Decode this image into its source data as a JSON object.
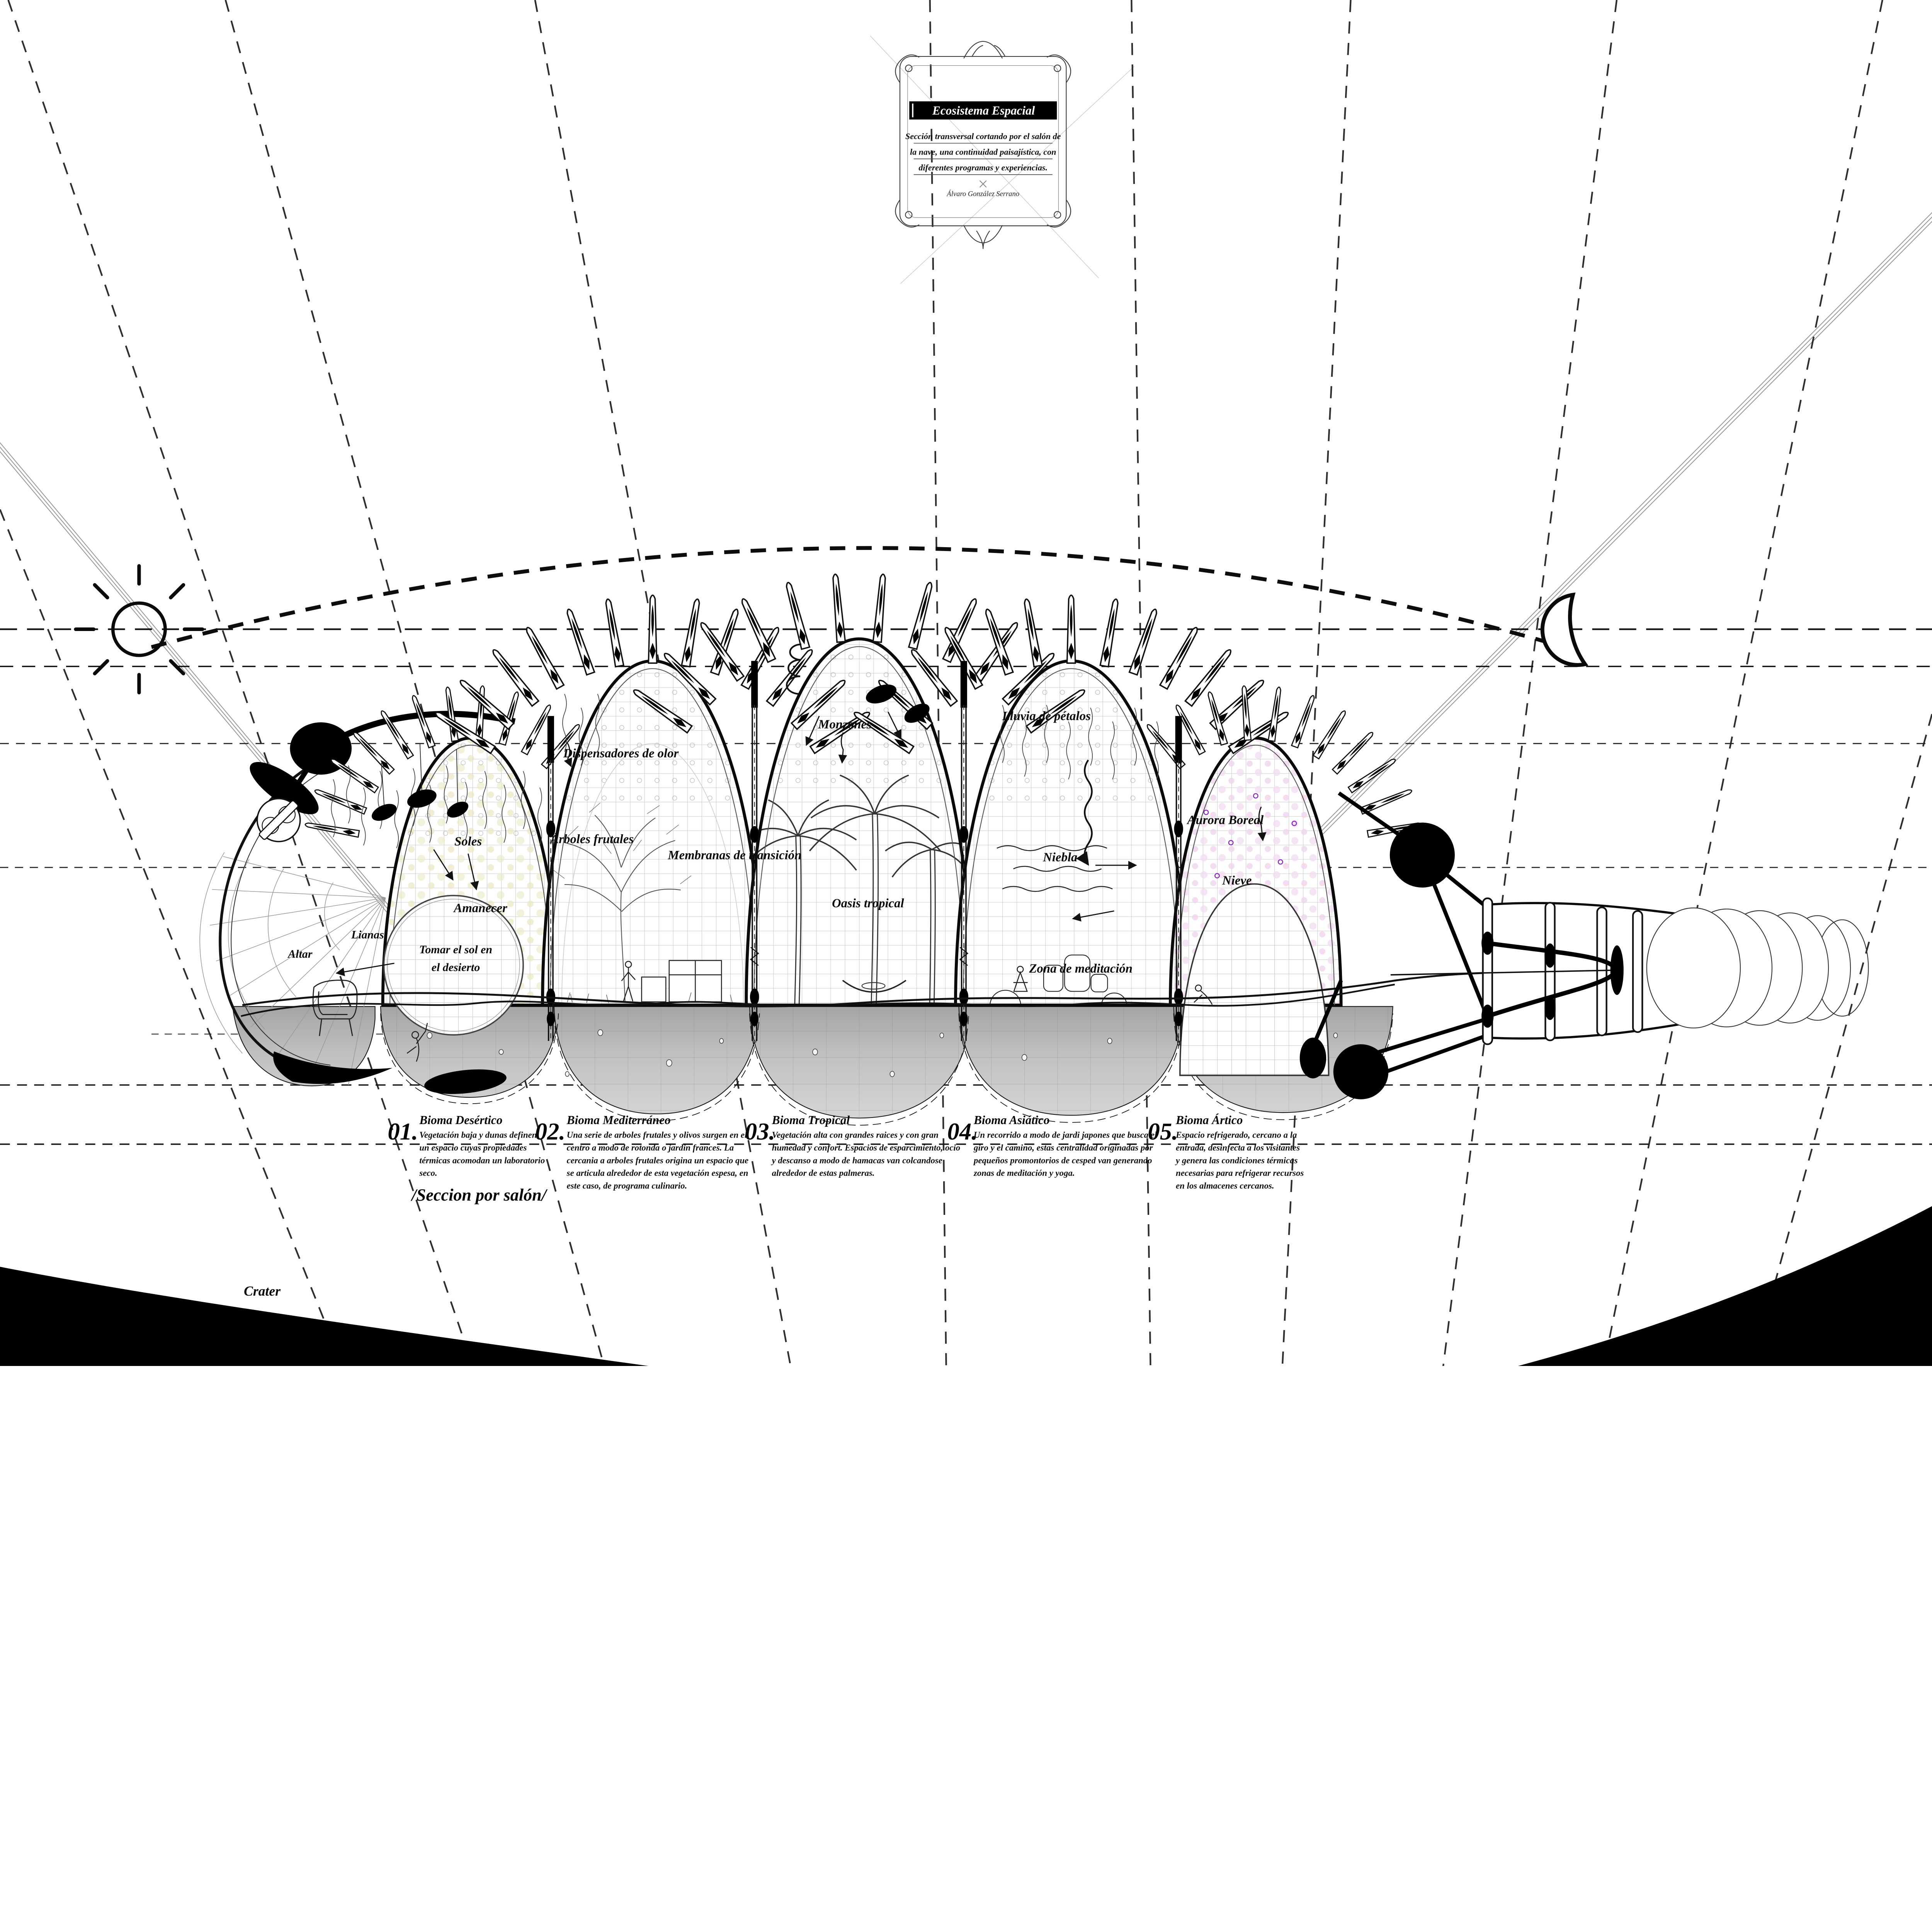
{
  "title_block": {
    "title": "Ecosistema Espacial",
    "subtitle_lines": [
      "Sección transversal cortando por el salón de",
      "la nave, una continuidad paisajística, con",
      "diferentes programas y experiencias."
    ],
    "author": "Álvaro González Serrano"
  },
  "annotations": {
    "soles": "Soles",
    "amanecer": "Amanecer",
    "lianas": "Lianas",
    "altar": "Altar",
    "tomar_1": "Tomar el sol en",
    "tomar_2": "el desierto",
    "dispensadores": "Dispensadores de olor",
    "arboles": "Árboles frutales",
    "membranas": "Membranas de transición",
    "monzones": "Monzones",
    "oasis": "Oasis tropical",
    "lluvia": "Lluvia de pétalos",
    "niebla": "Niebla",
    "aurora": "Aurora Boreal",
    "nieve": "Nieve",
    "zona": "Zona de meditación",
    "crater": "Crater",
    "seccion": "/Seccion por salón/"
  },
  "legend": {
    "items": [
      {
        "number": "01.",
        "name": "Bioma Desértico",
        "lines": [
          "Vegetación baja y dunas definen",
          "un espacio cuyas propiedades",
          "térmicas acomodan un laboratorio",
          "seco."
        ]
      },
      {
        "number": "02.",
        "name": "Bioma Mediterráneo",
        "lines": [
          "Una serie de arboles frutales y olivos surgen en el",
          "centro a modo de rotonda o jardin frances. La",
          "cercania a arboles frutales origina un espacio que",
          "se articula alrededor de esta vegetación espesa, en",
          "este caso, de programa culinario."
        ]
      },
      {
        "number": "03.",
        "name": "Bioma Tropical",
        "lines": [
          "Vegetación alta con grandes raices y con gran",
          "humedad y confort. Espacios de esparcimiento, ocio",
          "y descanso a modo de hamacas van colcandose",
          "alrededor de estas palmeras."
        ]
      },
      {
        "number": "04.",
        "name": "Bioma Asiático",
        "lines": [
          "Un recorrido a modo de jardi japones que busca el",
          "giro y el camino, estas centralidad originadas por",
          "pequeños promontorios de cesped van generando",
          "zonas de meditación y yoga."
        ]
      },
      {
        "number": "05.",
        "name": "Bioma Ártico",
        "lines": [
          "Espacio refrigerado, cercano a la",
          "entrada, desinfecta a los visitantes",
          "y genera las condiciones térmicas",
          "necesarias para refrigerar recursos",
          "en los almacenes cercanos."
        ]
      }
    ]
  },
  "icons": {
    "sun": "sun-icon",
    "moon": "crescent-moon-icon"
  },
  "colors": {
    "ink": "#0a0a0a",
    "lattice_gray": "#b9b9b9",
    "ground_gray": "#a6a6a6",
    "desert_dot": "#ecebcb",
    "arctic_dot": "#f3ddf1",
    "aurora_accent": "#8c2fb8",
    "sightline_gray": "#9a9a9a"
  }
}
